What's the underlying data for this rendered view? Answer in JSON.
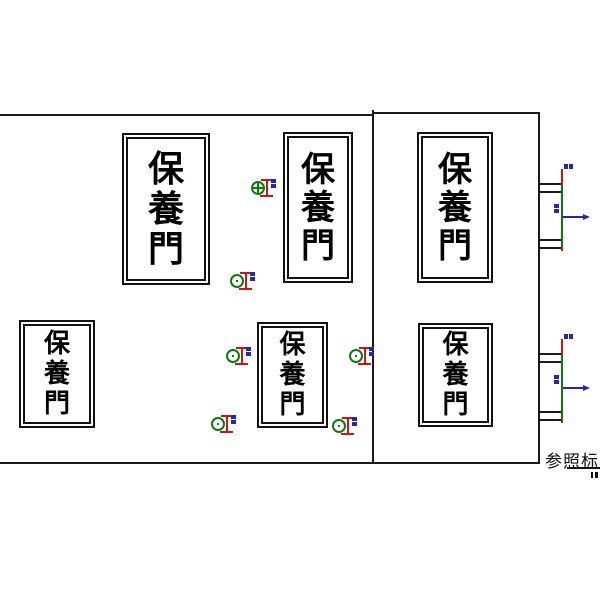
{
  "canvas": {
    "width": 600,
    "height": 600,
    "background": "#ffffff"
  },
  "colors": {
    "line": "#1a1a1a",
    "door_frame": "#111111",
    "marker_green": "#0a7c0a",
    "tick_red": "#cc1515",
    "arrow_blue": "#2727ae"
  },
  "door_label_text": "保養門",
  "reference_label": {
    "text": "参照标高"
  },
  "walls": [
    {
      "name": "left-section-top-wall",
      "x": 0,
      "y": 114,
      "w": 374,
      "h": 2
    },
    {
      "name": "right-section-top-wall",
      "x": 372,
      "y": 112,
      "w": 168,
      "h": 2
    },
    {
      "name": "divider-wall",
      "x": 372,
      "y": 110,
      "w": 2,
      "h": 354
    },
    {
      "name": "right-wall",
      "x": 538,
      "y": 112,
      "w": 2,
      "h": 352
    },
    {
      "name": "bottom-wall",
      "x": 0,
      "y": 462,
      "w": 540,
      "h": 2
    }
  ],
  "doors": [
    {
      "x": 122,
      "y": 133,
      "w": 88,
      "h": 152,
      "font": 36
    },
    {
      "x": 283,
      "y": 132,
      "w": 70,
      "h": 151,
      "font": 34
    },
    {
      "x": 417,
      "y": 132,
      "w": 76,
      "h": 151,
      "font": 34
    },
    {
      "x": 19,
      "y": 320,
      "w": 76,
      "h": 108,
      "font": 26
    },
    {
      "x": 257,
      "y": 322,
      "w": 71,
      "h": 106,
      "font": 26
    },
    {
      "x": 418,
      "y": 323,
      "w": 75,
      "h": 104,
      "font": 26
    }
  ],
  "markers": [
    {
      "x": 259,
      "y": 188,
      "style": "cross"
    },
    {
      "x": 238,
      "y": 281,
      "style": "dot"
    },
    {
      "x": 234,
      "y": 356,
      "style": "dot"
    },
    {
      "x": 357,
      "y": 356,
      "style": "dot"
    },
    {
      "x": 219,
      "y": 424,
      "style": "dot"
    },
    {
      "x": 340,
      "y": 426,
      "style": "dot"
    }
  ],
  "connectors": [
    {
      "beam_top_y": 183,
      "beam_bottom_y": 239,
      "arrow_y": 216
    },
    {
      "beam_top_y": 353,
      "beam_bottom_y": 411,
      "arrow_y": 387
    }
  ]
}
